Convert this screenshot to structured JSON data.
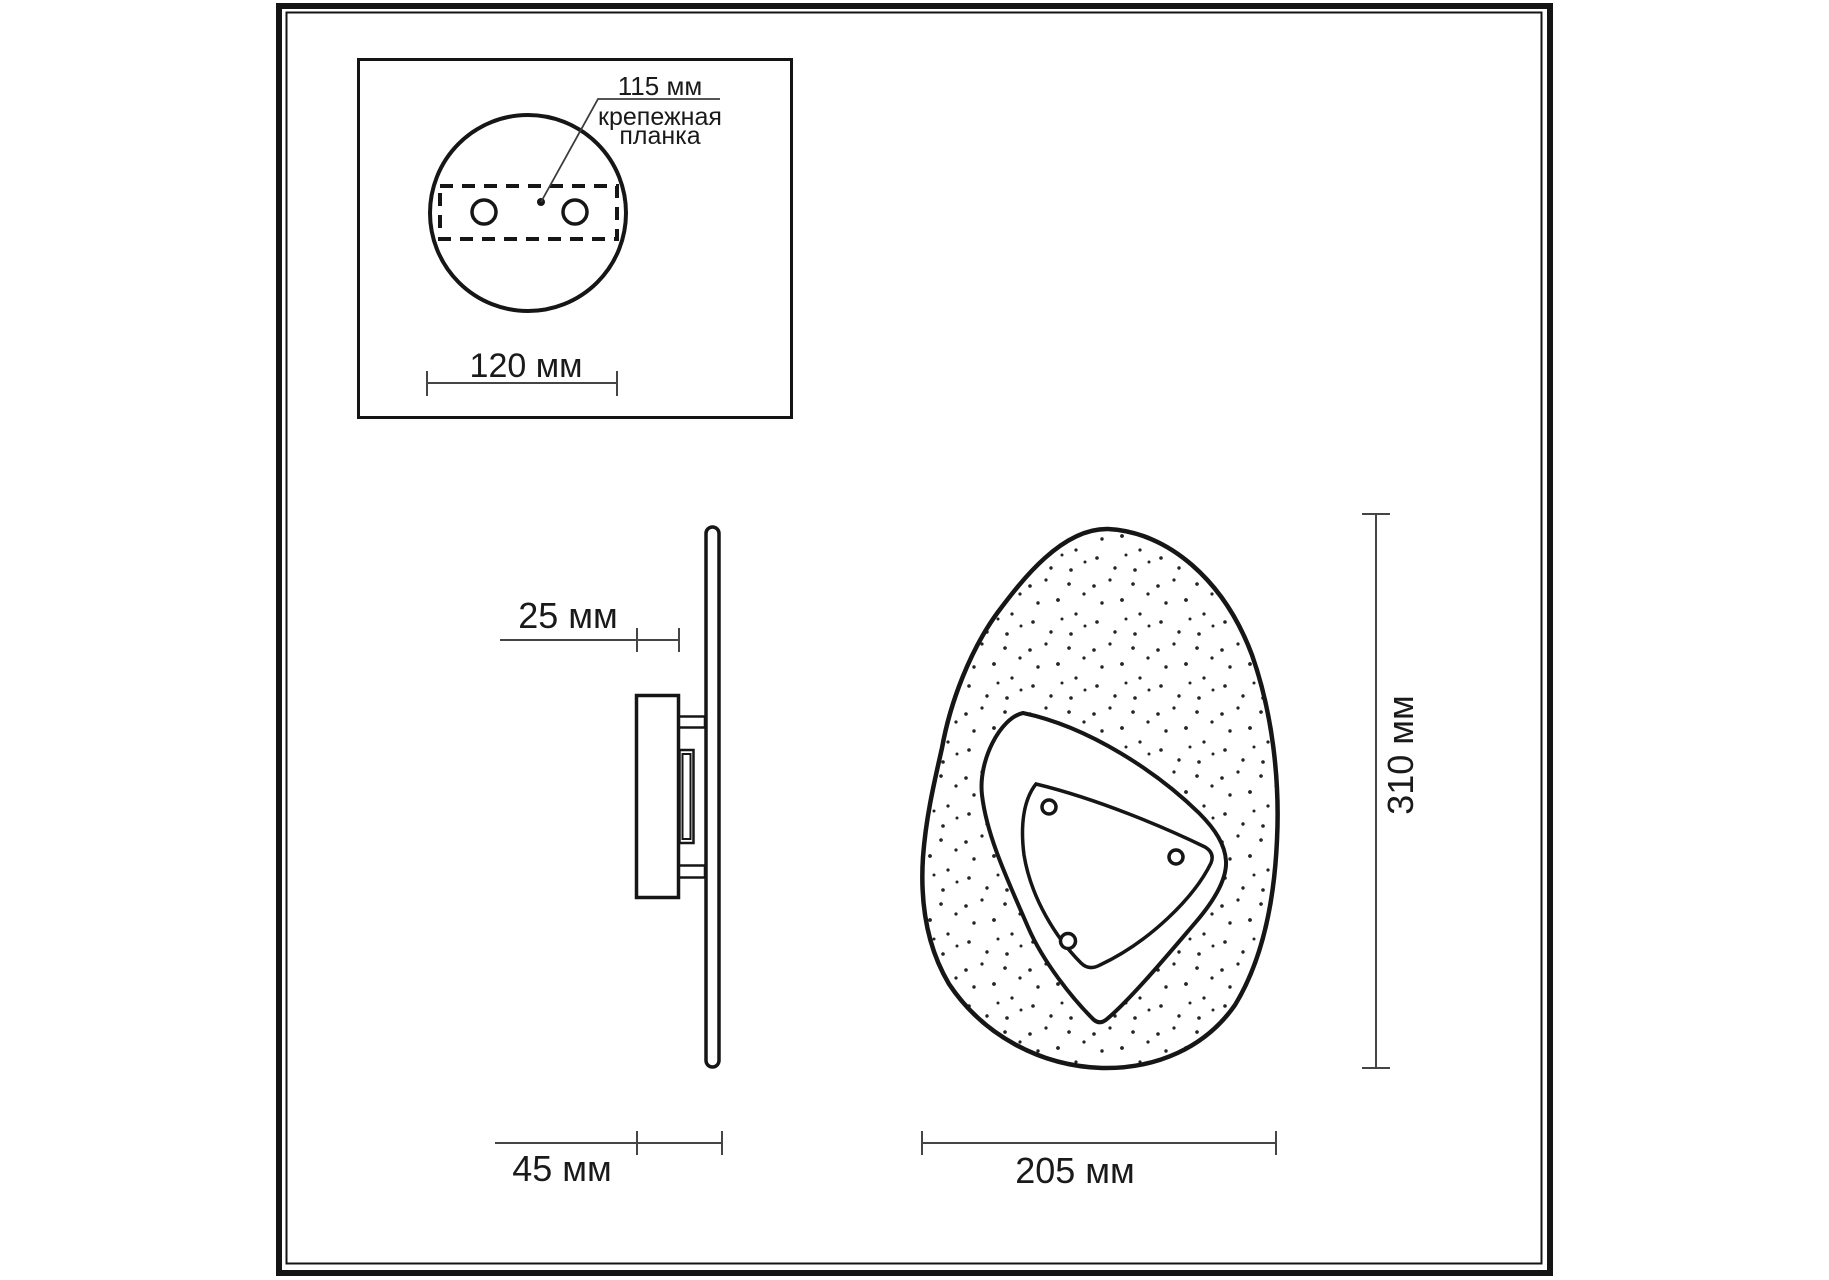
{
  "detail_inset": {
    "hole_spacing_label": "115 мм",
    "plate_label_line1": "крепежная",
    "plate_label_line2": "планка",
    "base_width_label": "120 мм"
  },
  "side_view": {
    "depth_front_label": "25 мм",
    "depth_total_label": "45 мм"
  },
  "front_view": {
    "height_label": "310 мм",
    "width_label": "205 мм"
  },
  "colors": {
    "ink": "#161616",
    "dim_line": "#454545",
    "text": "#1a1a1a",
    "background": "#ffffff"
  }
}
